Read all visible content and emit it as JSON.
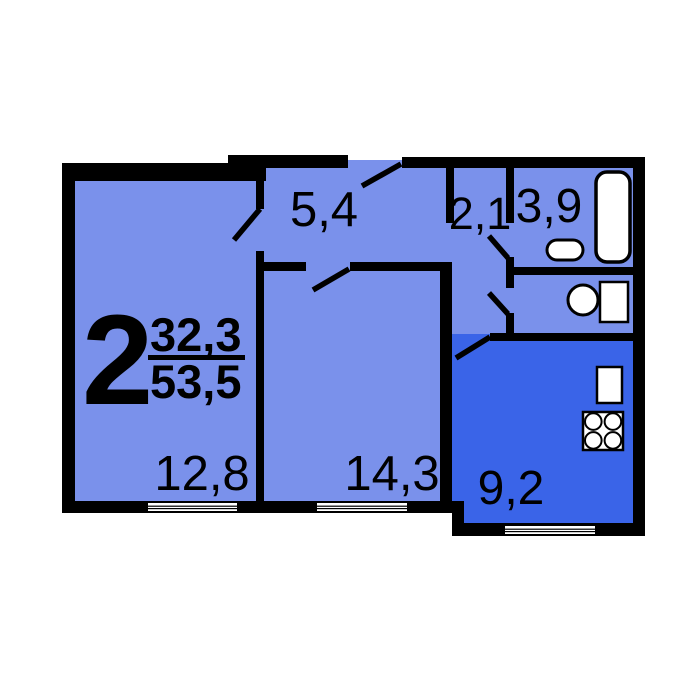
{
  "floorplan": {
    "apartment_type": "2",
    "area_living": "32,3",
    "area_total": "53,5",
    "rooms": {
      "living_room": {
        "label": "12,8"
      },
      "bedroom": {
        "label": "14,3"
      },
      "hallway": {
        "label": "5,4"
      },
      "corridor": {
        "label": "2,1"
      },
      "bathroom": {
        "label": "3,9"
      },
      "kitchen": {
        "label": "9,2"
      }
    },
    "fixtures": [
      "bathtub-icon",
      "washbasin-icon",
      "toilet-icon",
      "kitchen-sink-icon",
      "stove-icon"
    ],
    "colors": {
      "room_fill": "#7a91eb",
      "kitchen_fill": "#3a64e8",
      "wall": "#000000",
      "fixture_fill": "#ffffff",
      "background": "#ffffff"
    }
  }
}
